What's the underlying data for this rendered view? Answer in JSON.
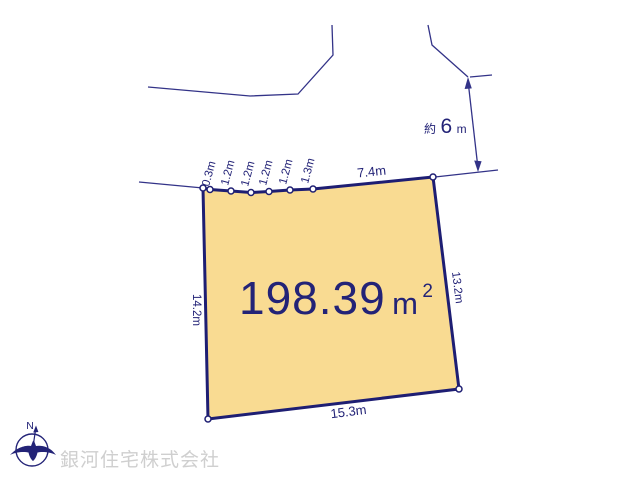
{
  "diagram": {
    "area": {
      "value": "198.39",
      "unit": "m",
      "superscript": "2"
    },
    "dimensions": {
      "top_segments": [
        "0.3m",
        "1.2m",
        "1.2m",
        "1.2m",
        "1.2m",
        "1.3m"
      ],
      "top": "7.4m",
      "right": "13.2m",
      "bottom": "15.3m",
      "left": "14.2m"
    },
    "road_width": {
      "prefix": "約",
      "value": "6",
      "unit": "m"
    }
  },
  "compass": {
    "north": "N"
  },
  "footer": {
    "company": "銀河住宅株式会社"
  },
  "colors": {
    "parcel_fill": "#F9DB92",
    "parcel_border": "#1E1E73",
    "line": "#333388",
    "text": "#232377",
    "watermark": "#CFCFCF"
  }
}
